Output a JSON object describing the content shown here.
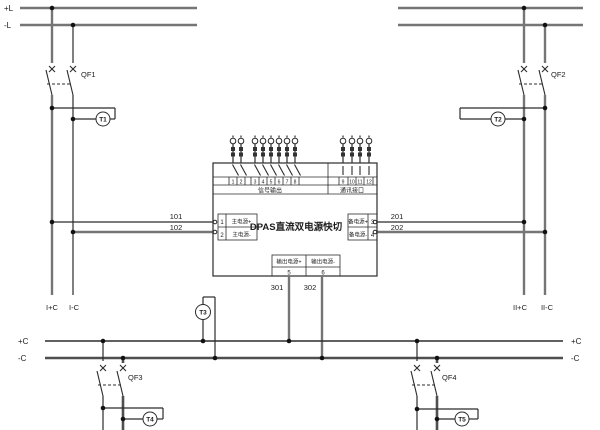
{
  "diagram": {
    "kind": "dc-dual-power-transfer-schematic",
    "background": "#ffffff"
  },
  "top_buses": {
    "pos_label": "+L",
    "neg_label": "-L"
  },
  "bottom_buses": {
    "pos_label_left": "+C",
    "neg_label_left": "-C",
    "pos_label_right": "+C",
    "neg_label_right": "-C"
  },
  "breakers": {
    "qf1": "QF1",
    "qf2": "QF2",
    "qf3": "QF3",
    "qf4": "QF4"
  },
  "monitors": {
    "t1": "T1",
    "t2": "T2",
    "t3": "T3",
    "t4": "T4",
    "t5": "T5"
  },
  "feeders": {
    "left_pos": "I+C",
    "left_neg": "I-C",
    "right_pos": "II+C",
    "right_neg": "II-C"
  },
  "module": {
    "title": "DPAS直流双电源快切",
    "signal_section_label": "信号输出",
    "comm_section_label": "通讯接口",
    "signal_terminal_numbers": [
      "1",
      "2",
      "3",
      "4",
      "5",
      "6",
      "7",
      "8"
    ],
    "comm_terminal_numbers": [
      "9",
      "10",
      "11",
      "12"
    ],
    "main_input": {
      "pos": {
        "no": "1",
        "label": "主电源+",
        "wire": "101"
      },
      "neg": {
        "no": "2",
        "label": "主电源-",
        "wire": "102"
      }
    },
    "backup_input": {
      "pos": {
        "no": "3",
        "label": "备电源+",
        "wire": "201"
      },
      "neg": {
        "no": "4",
        "label": "备电源-",
        "wire": "202"
      }
    },
    "output": {
      "pos": {
        "no": "5",
        "label": "输出电源+",
        "wire": "301"
      },
      "neg": {
        "no": "6",
        "label": "输出电源-",
        "wire": "302"
      }
    }
  },
  "colors": {
    "wire_thin": "#2b2b2b",
    "wire_thick": "#757575",
    "bus_neg": "#4f4f4f",
    "text": "#1c1c1c"
  }
}
